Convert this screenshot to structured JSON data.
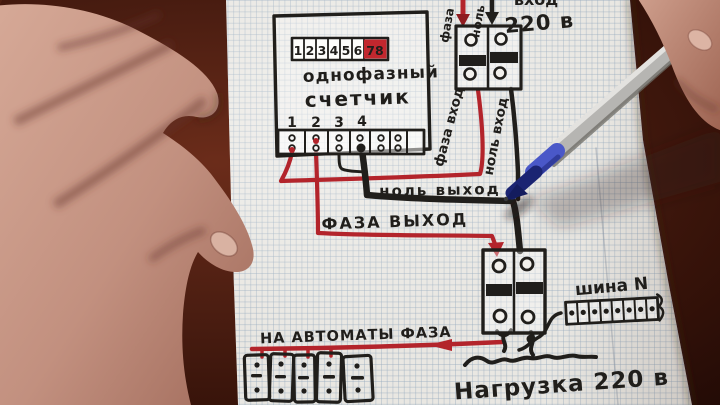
{
  "scene_title": "hand-drawn single-phase meter wiring diagram on squared paper",
  "meter": {
    "display_digits": [
      "1",
      "2",
      "3",
      "4",
      "5",
      "6"
    ],
    "display_red_digits": "78",
    "name_line1": "однофазный",
    "name_line2": "счетчик",
    "terminals": [
      "1",
      "2",
      "3",
      "4"
    ]
  },
  "input_breaker": {
    "wire_phase_label": "фаза",
    "wire_neutral_label": "ноль",
    "caption_top": "вход",
    "caption_voltage": "220 в"
  },
  "wire_labels": {
    "phase_in": "фаза вход",
    "neutral_in": "ноль вход",
    "neutral_out": "ноль выход",
    "phase_out": "ФАЗА ВЫХОД"
  },
  "bottom": {
    "to_automats": "НА АВТОМАТЫ ФАЗА",
    "n_bus": "шина N",
    "load": "Нагрузка 220 в"
  },
  "colors": {
    "phase_wire": "#b3242b",
    "neutral_wire": "#201e1b",
    "display_red": "#c2272e",
    "paper": "#e9e7e2",
    "table": "#4a1d11",
    "pen_blue": "#4a58c8",
    "skin": "#c79a8a"
  }
}
